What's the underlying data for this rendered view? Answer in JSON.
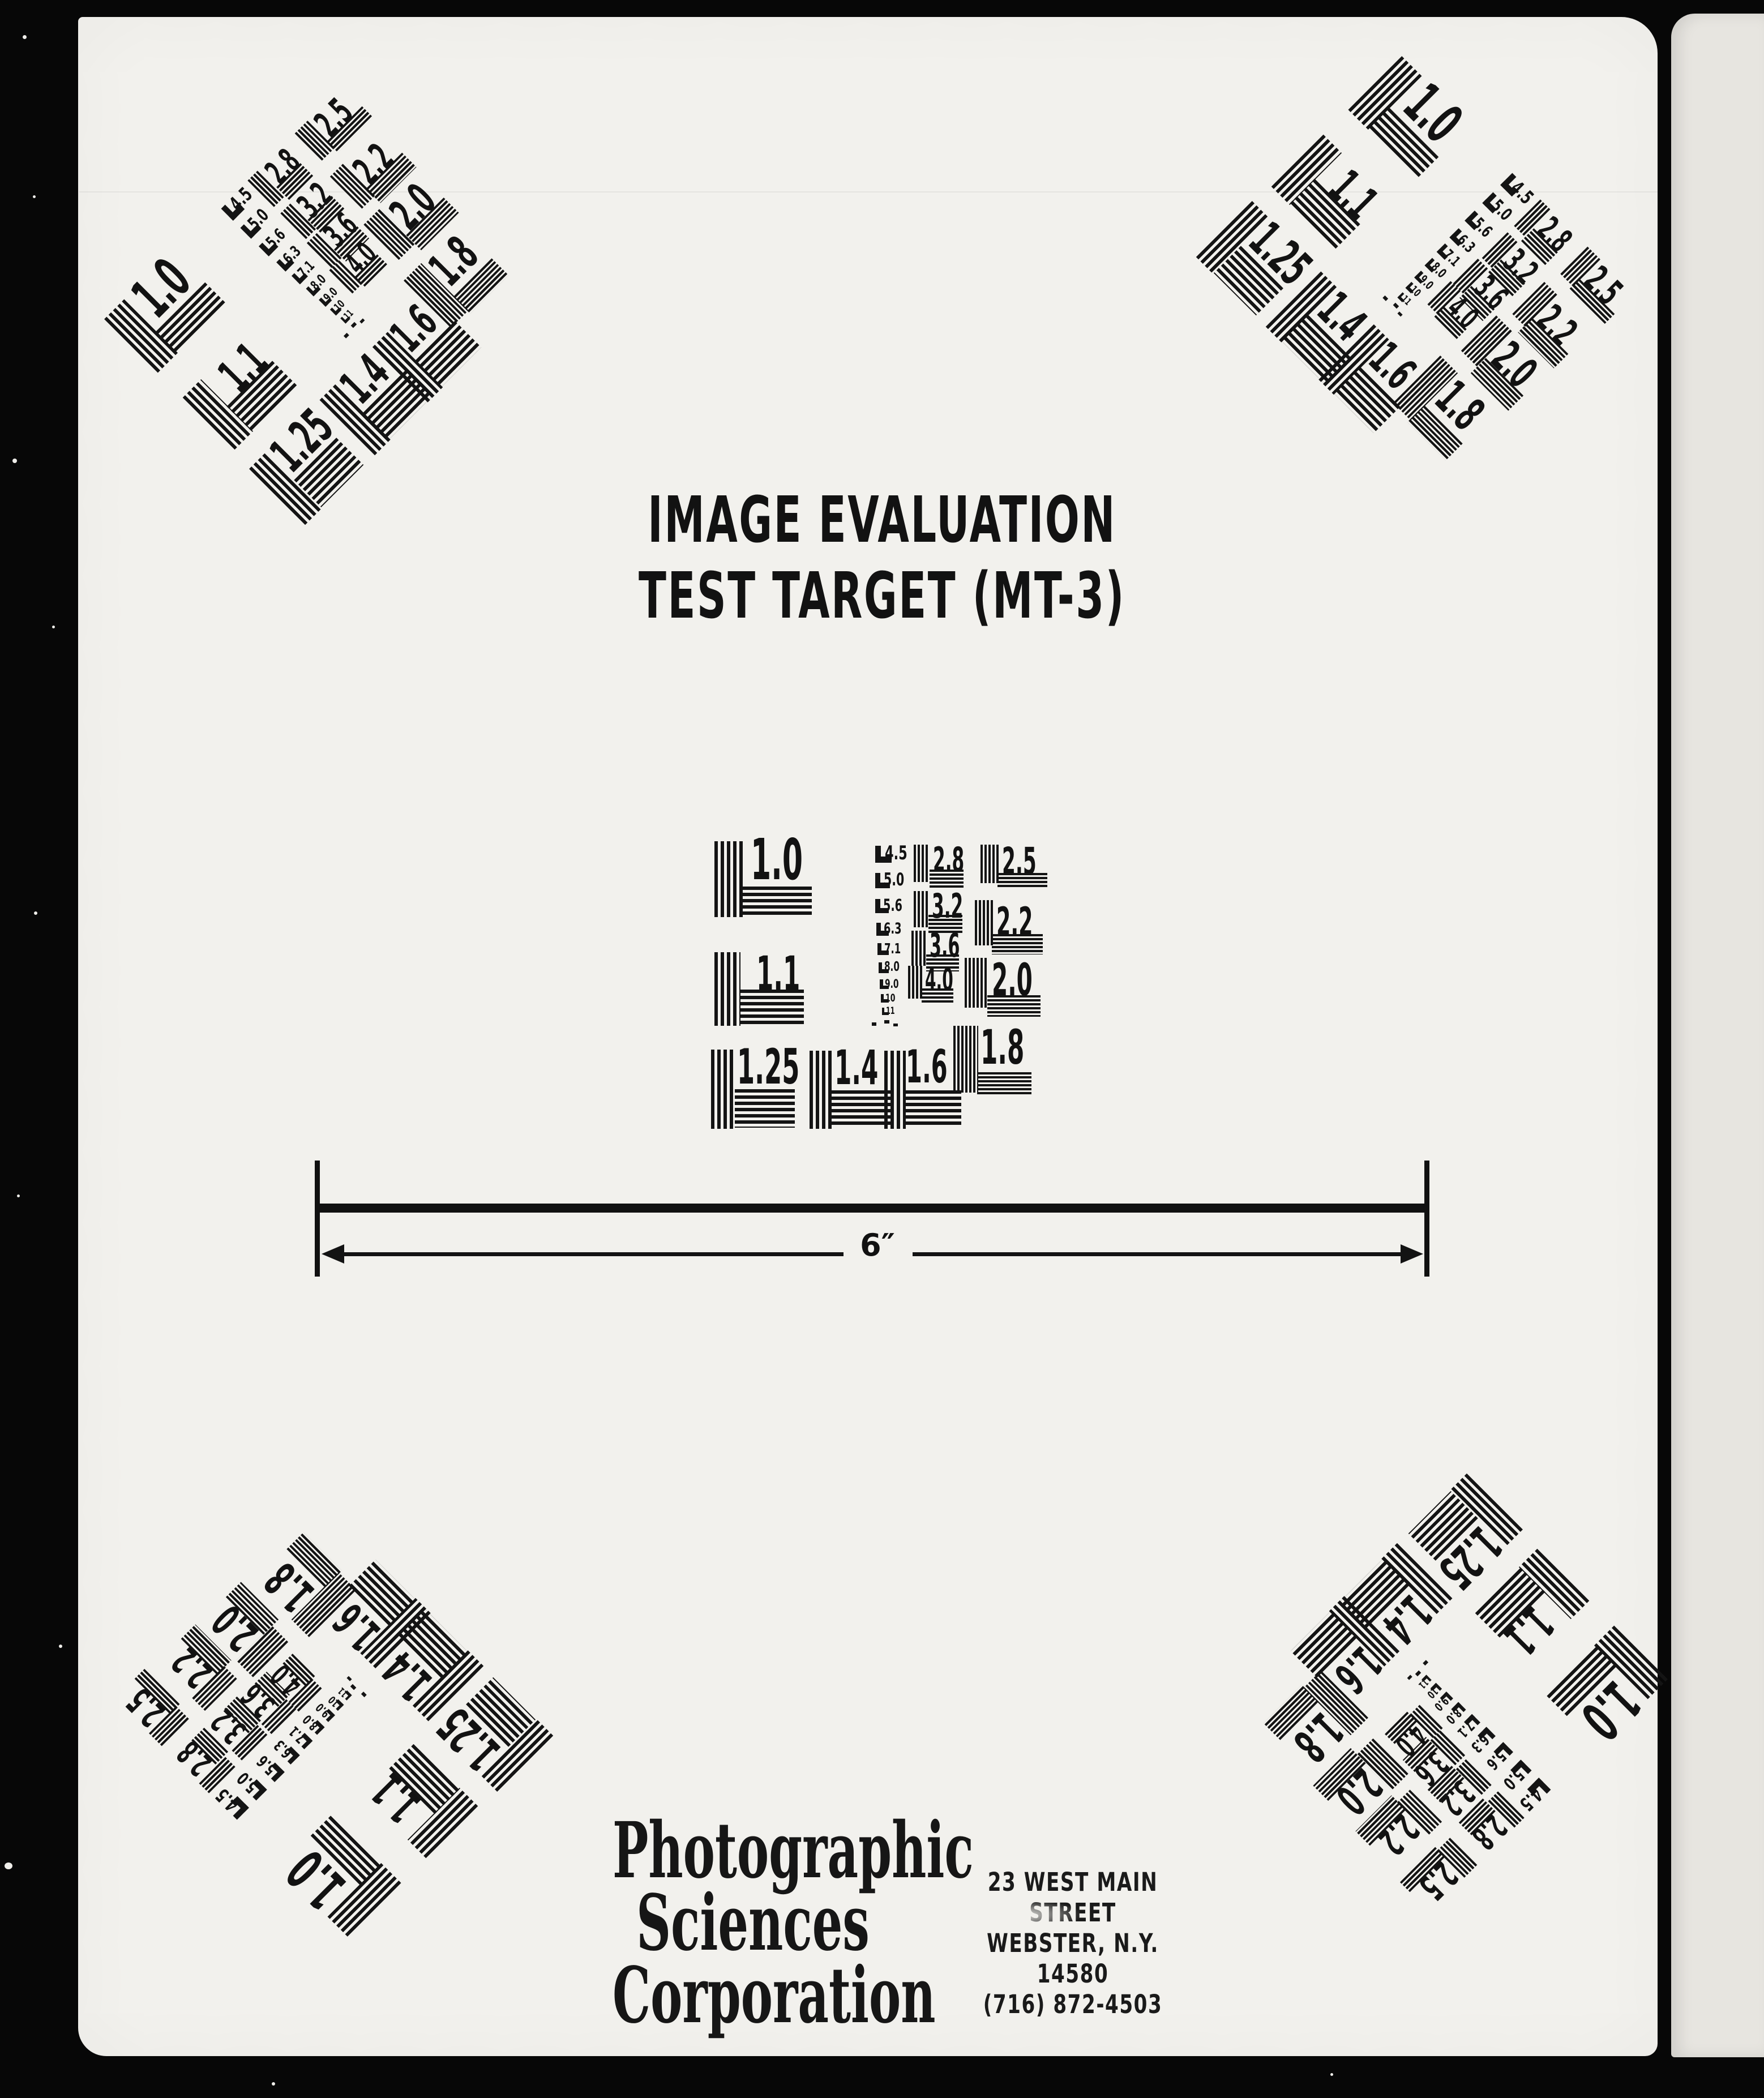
{
  "colors": {
    "film_black": "#070707",
    "main_page": "#f2f1ed",
    "side_page": "#e7e5e0",
    "ink": "#141414"
  },
  "title": {
    "line1": "IMAGE EVALUATION",
    "line2": "TEST TARGET (MT-3)"
  },
  "resolution_chart": {
    "large_values": [
      "1.0",
      "1.1",
      "1.25",
      "1.4",
      "1.6"
    ],
    "mid_values": [
      "2.8",
      "3.2",
      "3.6",
      "4.0"
    ],
    "right_values": [
      "2.5",
      "2.2",
      "2.0",
      "1.8"
    ],
    "small_values": [
      "4.5",
      "5.0",
      "5.6",
      "6.3",
      "7.1",
      "8.0",
      "9.0",
      "10",
      "11"
    ]
  },
  "scale_bar": {
    "label": "6″"
  },
  "footer": {
    "company": [
      "Photographic",
      "Sciences",
      "Corporation"
    ],
    "address": [
      "23 WEST MAIN STREET",
      "WEBSTER, N.Y. 14580",
      "(716) 872-4503"
    ]
  }
}
